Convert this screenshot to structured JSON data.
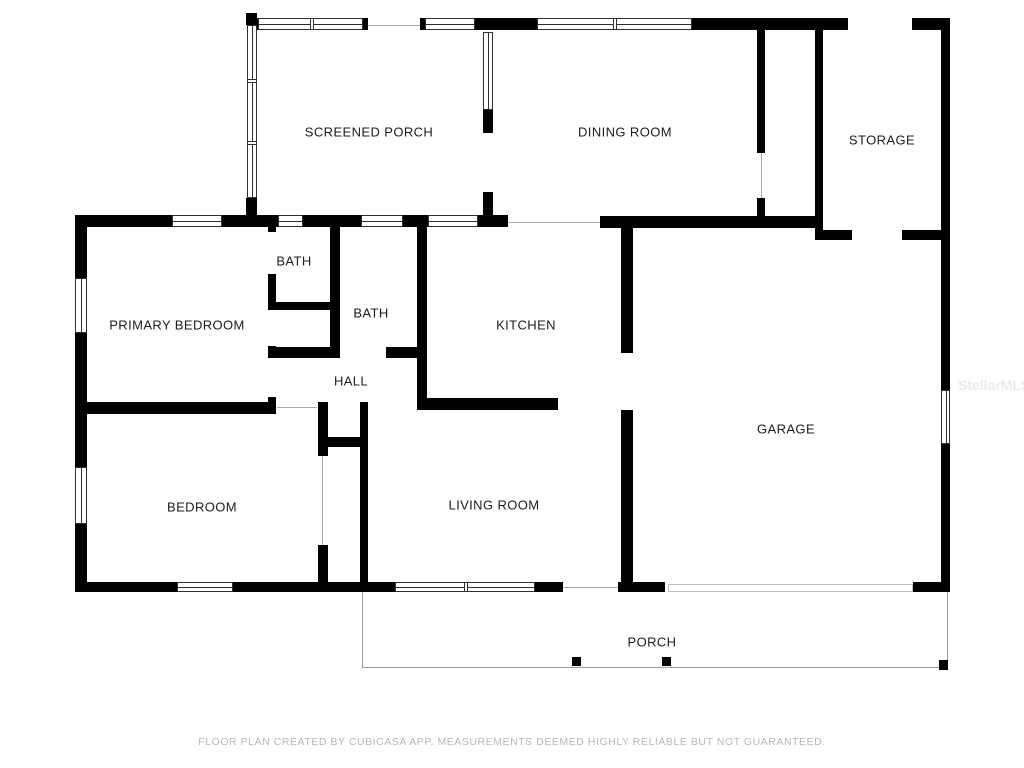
{
  "floor_plan": {
    "colors": {
      "wall": "#000000",
      "room_label": "#1c1c1c",
      "opening_line": "#ababab",
      "porch_outline": "#9a9a9a",
      "footer_text": "#b8b8b8",
      "watermark_text": "#ebebeb",
      "background": "#ffffff"
    },
    "rooms": [
      {
        "id": "screened-porch",
        "label": "SCREENED PORCH",
        "cx": 369,
        "cy": 132
      },
      {
        "id": "dining-room",
        "label": "DINING ROOM",
        "cx": 625,
        "cy": 132
      },
      {
        "id": "storage",
        "label": "STORAGE",
        "cx": 882,
        "cy": 140
      },
      {
        "id": "bath-1",
        "label": "BATH",
        "cx": 294,
        "cy": 261
      },
      {
        "id": "bath-2",
        "label": "BATH",
        "cx": 371,
        "cy": 313
      },
      {
        "id": "primary-bedroom",
        "label": "PRIMARY BEDROOM",
        "cx": 177,
        "cy": 325
      },
      {
        "id": "kitchen",
        "label": "KITCHEN",
        "cx": 526,
        "cy": 325
      },
      {
        "id": "hall",
        "label": "HALL",
        "cx": 351,
        "cy": 381
      },
      {
        "id": "garage",
        "label": "GARAGE",
        "cx": 786,
        "cy": 429
      },
      {
        "id": "bedroom",
        "label": "BEDROOM",
        "cx": 202,
        "cy": 507
      },
      {
        "id": "living-room",
        "label": "LIVING ROOM",
        "cx": 494,
        "cy": 505
      },
      {
        "id": "porch",
        "label": "PORCH",
        "cx": 652,
        "cy": 642
      }
    ],
    "walls": [
      [
        250,
        18,
        8,
        12
      ],
      [
        363,
        18,
        5,
        12
      ],
      [
        420,
        18,
        5,
        12
      ],
      [
        475,
        18,
        18,
        12
      ],
      [
        493,
        18,
        44,
        12
      ],
      [
        692,
        18,
        156,
        12
      ],
      [
        912,
        18,
        38,
        12
      ],
      [
        75,
        215,
        97,
        12
      ],
      [
        222,
        215,
        56,
        12
      ],
      [
        303,
        215,
        58,
        12
      ],
      [
        403,
        215,
        25,
        12
      ],
      [
        478,
        215,
        30,
        12
      ],
      [
        600,
        216,
        223,
        12
      ],
      [
        815,
        230,
        37,
        10
      ],
      [
        902,
        230,
        39,
        10
      ],
      [
        75,
        215,
        12,
        63
      ],
      [
        75,
        333,
        12,
        134
      ],
      [
        75,
        524,
        12,
        68
      ],
      [
        246,
        13,
        11,
        12
      ],
      [
        246,
        198,
        11,
        29
      ],
      [
        483,
        110,
        10,
        23
      ],
      [
        483,
        192,
        10,
        35
      ],
      [
        268,
        215,
        8,
        17
      ],
      [
        268,
        274,
        8,
        36
      ],
      [
        268,
        346,
        8,
        12
      ],
      [
        268,
        397,
        8,
        17
      ],
      [
        330,
        227,
        10,
        131
      ],
      [
        417,
        227,
        10,
        183
      ],
      [
        621,
        217,
        12,
        136
      ],
      [
        621,
        410,
        12,
        182
      ],
      [
        757,
        30,
        8,
        123
      ],
      [
        757,
        198,
        8,
        30
      ],
      [
        815,
        22,
        8,
        218
      ],
      [
        941,
        18,
        9,
        372
      ],
      [
        941,
        444,
        9,
        148
      ],
      [
        318,
        402,
        10,
        54
      ],
      [
        318,
        545,
        10,
        47
      ],
      [
        360,
        402,
        8,
        190
      ],
      [
        268,
        302,
        72,
        8
      ],
      [
        268,
        347,
        72,
        11
      ],
      [
        386,
        347,
        41,
        11
      ],
      [
        417,
        398,
        141,
        12
      ],
      [
        82,
        402,
        193,
        12
      ],
      [
        318,
        437,
        50,
        10
      ],
      [
        75,
        582,
        102,
        10
      ],
      [
        233,
        582,
        162,
        10
      ],
      [
        535,
        582,
        28,
        10
      ],
      [
        618,
        582,
        47,
        10
      ],
      [
        913,
        582,
        35,
        10
      ]
    ],
    "windows": [
      {
        "rect": [
          172,
          215,
          50,
          12
        ],
        "orient": "h",
        "mullions": []
      },
      {
        "rect": [
          278,
          215,
          25,
          12
        ],
        "orient": "h",
        "mullions": []
      },
      {
        "rect": [
          361,
          215,
          42,
          12
        ],
        "orient": "h",
        "mullions": []
      },
      {
        "rect": [
          428,
          215,
          50,
          12
        ],
        "orient": "h",
        "mullions": []
      },
      {
        "rect": [
          258,
          18,
          105,
          12
        ],
        "orient": "h",
        "mullions": [
          53
        ]
      },
      {
        "rect": [
          425,
          18,
          50,
          12
        ],
        "orient": "h",
        "mullions": []
      },
      {
        "rect": [
          537,
          18,
          155,
          12
        ],
        "orient": "h",
        "mullions": [
          77
        ]
      },
      {
        "rect": [
          247,
          25,
          10,
          173
        ],
        "orient": "v",
        "mullions": [
          55,
          117
        ]
      },
      {
        "rect": [
          483,
          32,
          10,
          78
        ],
        "orient": "v",
        "mullions": []
      },
      {
        "rect": [
          75,
          278,
          12,
          55
        ],
        "orient": "v",
        "mullions": []
      },
      {
        "rect": [
          75,
          467,
          12,
          57
        ],
        "orient": "v",
        "mullions": []
      },
      {
        "rect": [
          941,
          390,
          9,
          54
        ],
        "orient": "v",
        "mullions": []
      },
      {
        "rect": [
          177,
          582,
          56,
          10
        ],
        "orient": "h",
        "mullions": []
      },
      {
        "rect": [
          395,
          582,
          140,
          10
        ],
        "orient": "h",
        "mullions": [
          70
        ]
      }
    ],
    "opening_lines": [
      [
        508,
        222,
        600,
        222
      ],
      [
        368,
        25,
        420,
        25
      ],
      [
        277,
        407,
        317,
        407
      ],
      [
        563,
        587,
        618,
        587
      ],
      [
        761,
        153,
        761,
        198
      ],
      [
        322,
        456,
        322,
        545
      ]
    ],
    "garage_door": {
      "rect": [
        668,
        584,
        245,
        8
      ]
    },
    "porch_outline": [
      [
        362,
        592,
        362,
        668
      ],
      [
        362,
        667,
        948,
        667
      ],
      [
        947,
        592,
        947,
        668
      ]
    ],
    "posts": [
      [
        572,
        657,
        9,
        9
      ],
      [
        662,
        657,
        9,
        9
      ],
      [
        939,
        660,
        9,
        10
      ]
    ]
  },
  "footer": {
    "disclaimer": "FLOOR PLAN CREATED BY CUBICASA APP. MEASUREMENTS DEEMED HIGHLY RELIABLE BUT NOT GUARANTEED."
  },
  "watermark": {
    "text": "StellarMLS"
  }
}
